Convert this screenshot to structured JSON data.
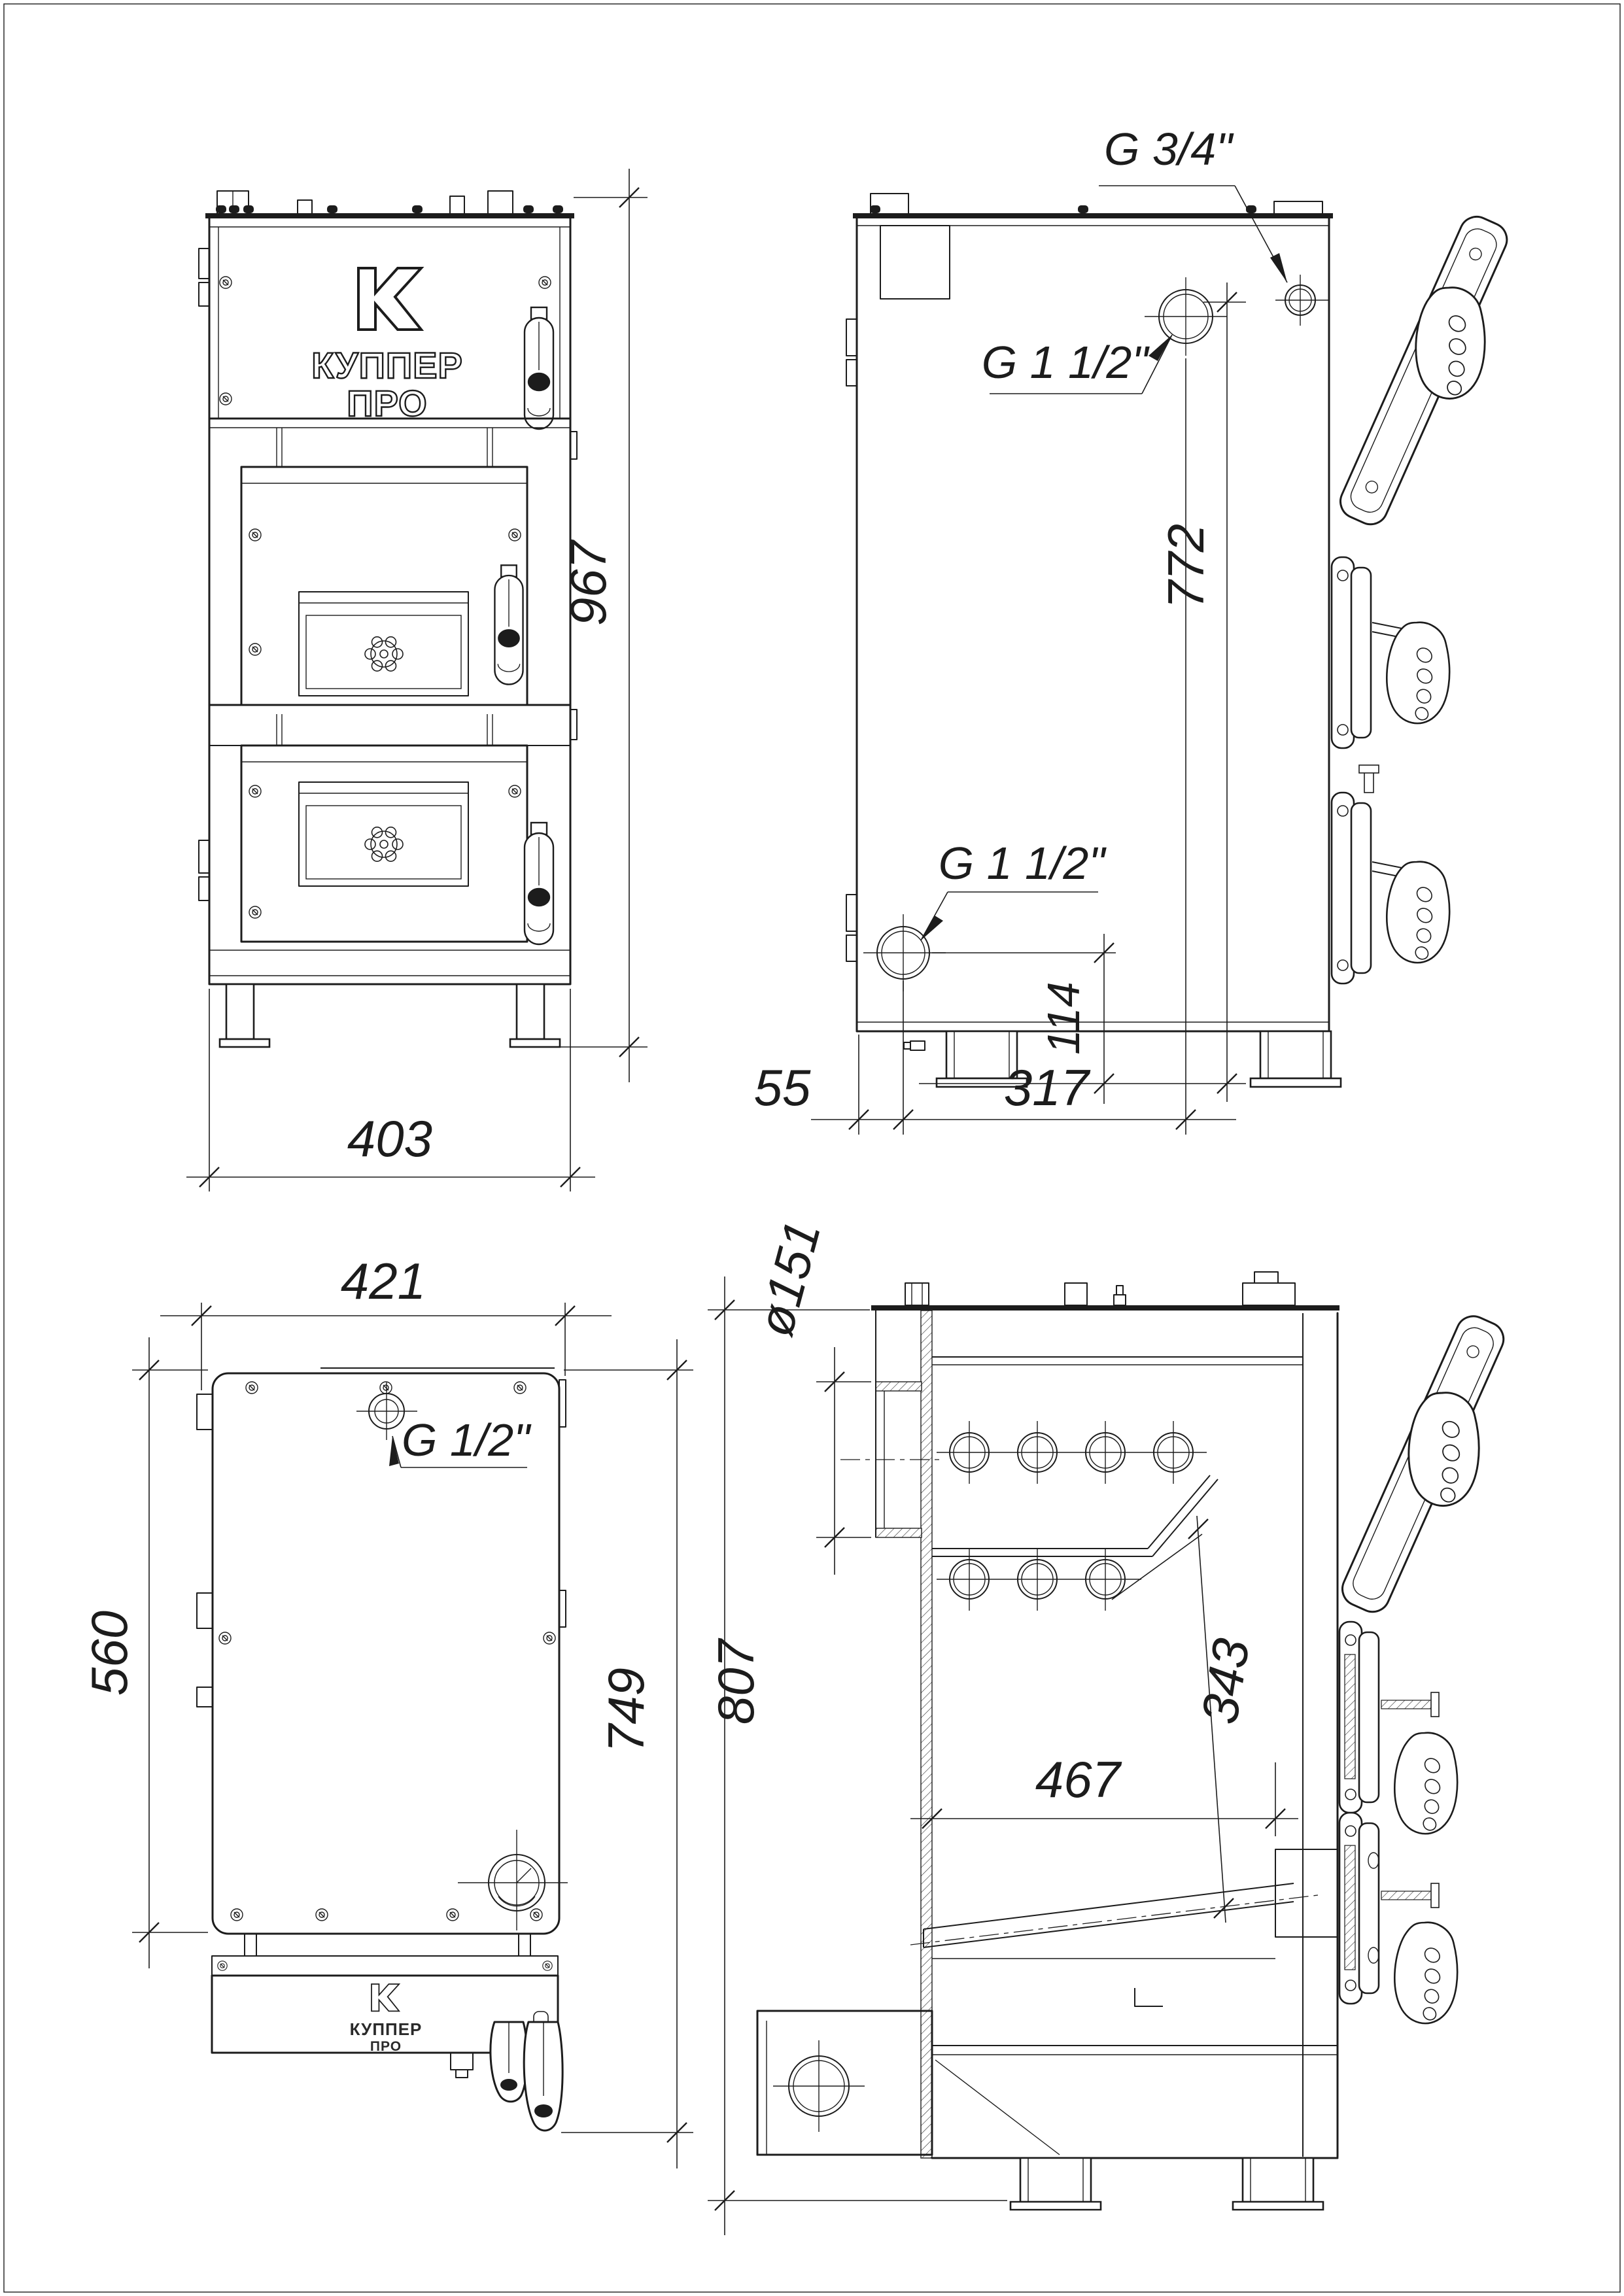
{
  "colors": {
    "line": "#1c1c1c",
    "background": "#ffffff"
  },
  "drawing": {
    "front_view": {
      "width_dim": "403",
      "height_dim": "967",
      "logo_line1": "КУППЕР",
      "logo_line2": "ПРО"
    },
    "side_view": {
      "flue_thread_label": "G 3/4\"",
      "supply_thread_label": "G 1 1/2\"",
      "return_thread_label": "G 1 1/2\"",
      "supply_height_dim": "772",
      "return_height_dim": "114",
      "back_offset_dim": "55",
      "supply_offset_dim": "317"
    },
    "top_view": {
      "width_dim": "421",
      "body_depth_dim": "560",
      "total_depth_dim": "749",
      "sensor_thread_label": "G 1/2\"",
      "logo_line1": "КУППЕР",
      "logo_line2": "ПРО"
    },
    "section_view": {
      "flue_diameter_dim": "ø151",
      "firebox_depth_dim": "467",
      "firebox_diagonal_dim": "343",
      "total_height_dim": "807"
    }
  }
}
